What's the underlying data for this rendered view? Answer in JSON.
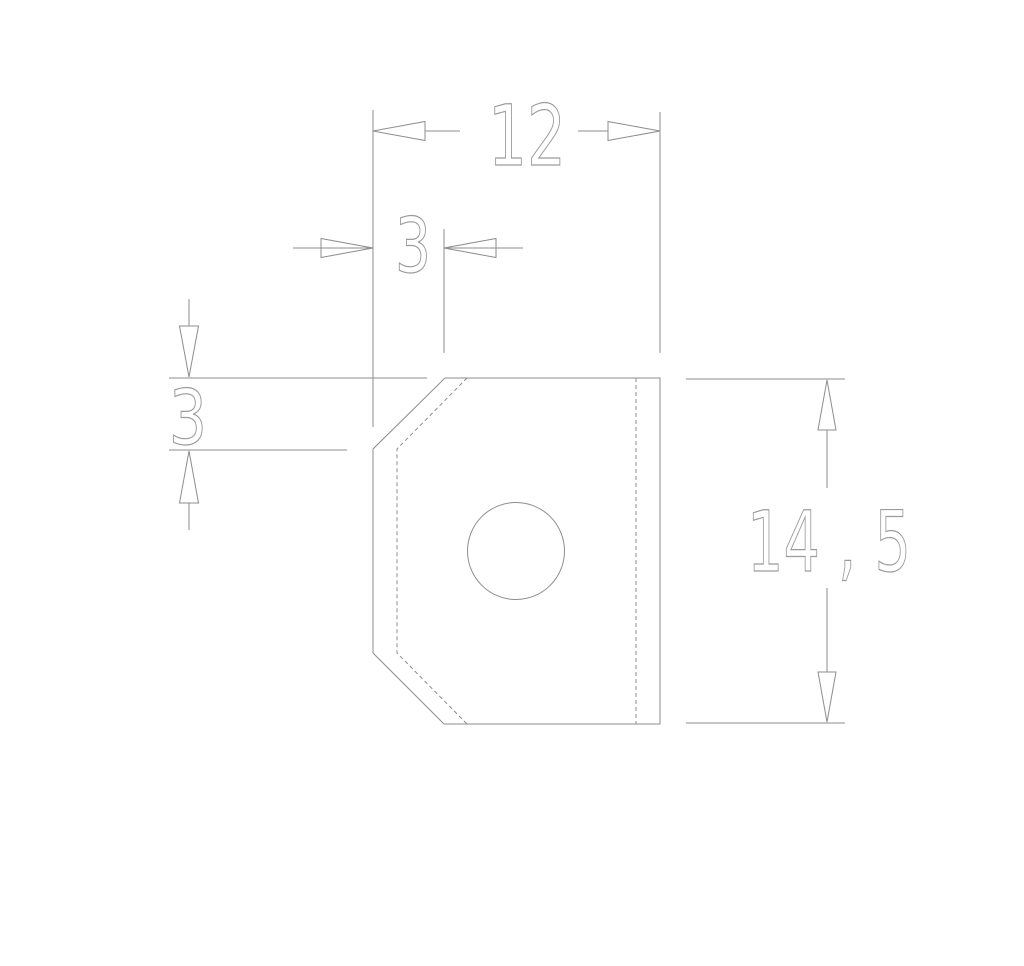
{
  "drawing": {
    "kind": "technical-part-drawing",
    "background_color": "#ffffff",
    "line_color": "#8d8d8d",
    "hidden_line_color": "#8d8d8d",
    "text_color": "#9b9b9b",
    "dimensions": {
      "width_label": "12",
      "top_chamfer_width_label": "3",
      "left_chamfer_height_label": "3",
      "height_label": "14 , 5"
    }
  }
}
